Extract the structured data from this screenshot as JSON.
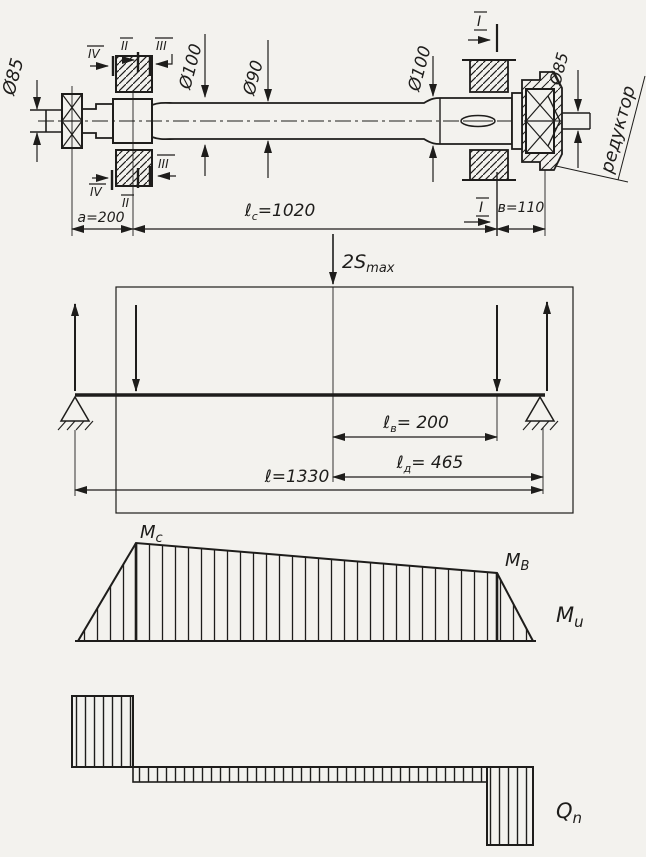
{
  "drawing": {
    "diameters": {
      "phi85_left": "Ø85",
      "phi100_left": "Ø100",
      "phi90": "Ø90",
      "phi100_right": "Ø100",
      "phi85_right": "Ø85"
    },
    "sections": {
      "iv_top": "IV",
      "ii_top": "II",
      "iii_top": "III",
      "iii_bottom": "III",
      "iv_bottom": "IV",
      "ii_bottom": "II",
      "i_top": "I",
      "i_bottom": "I"
    },
    "callout_reducer": "редуктор",
    "dims": {
      "a": "a=200",
      "lc_main": "ℓ",
      "lc_sub": "c",
      "lc_val": "=1020",
      "b": "в=110"
    }
  },
  "beam": {
    "force_main": "2S",
    "force_sub": "max",
    "dims": {
      "lv_main": "ℓ",
      "lv_sub": "в",
      "lv_val": "= 200",
      "ld_main": "ℓ",
      "ld_sub": "д",
      "ld_val": "= 465",
      "l_main": "ℓ",
      "l_val": "=1330"
    }
  },
  "moment": {
    "mc_main": "M",
    "mc_sub": "c",
    "mb_main": "M",
    "mb_sub": "B",
    "axis_main": "M",
    "axis_sub": "u"
  },
  "shear": {
    "axis_main": "Q",
    "axis_sub": "n"
  },
  "ink_color": "#1e1d1b",
  "paper_color": "#f3f2ee"
}
